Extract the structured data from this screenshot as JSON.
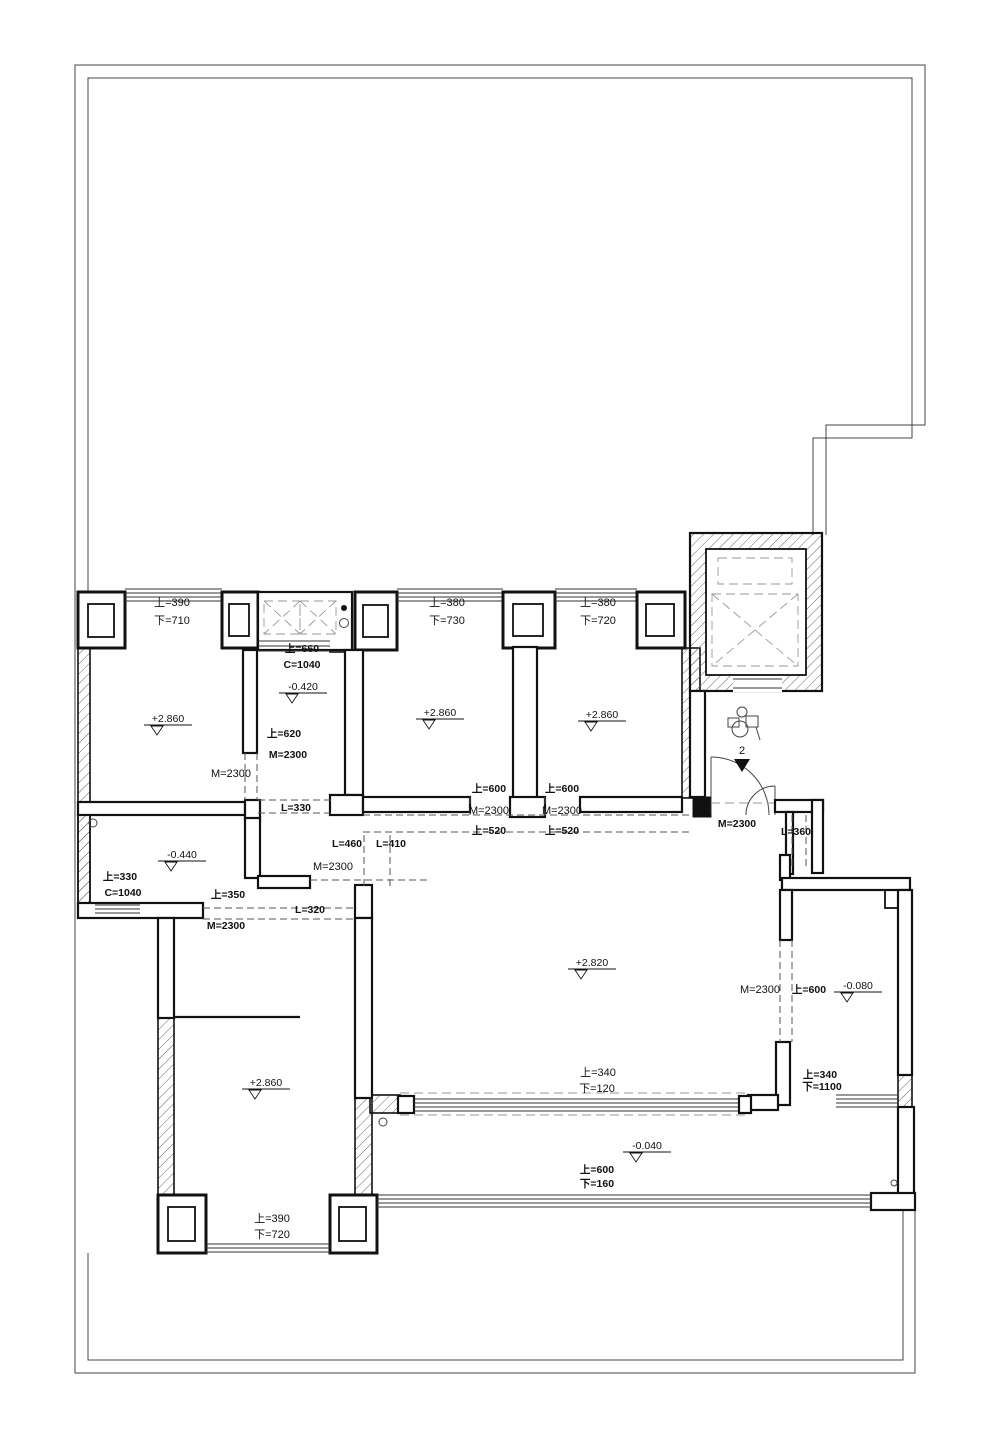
{
  "drawing": {
    "colors": {
      "wall": "#111111",
      "boundary": "#444444",
      "dashed_opening": "#555555",
      "background": "#ffffff"
    },
    "labels": [
      {
        "text": "上=390",
        "x": 172,
        "y": 606,
        "bold": false
      },
      {
        "text": "下=710",
        "x": 172,
        "y": 624,
        "bold": false
      },
      {
        "text": "上=380",
        "x": 447,
        "y": 606,
        "bold": false
      },
      {
        "text": "下=730",
        "x": 447,
        "y": 624,
        "bold": false
      },
      {
        "text": "上=380",
        "x": 598,
        "y": 606,
        "bold": false
      },
      {
        "text": "下=720",
        "x": 598,
        "y": 624,
        "bold": false
      },
      {
        "text": "上=660",
        "x": 302,
        "y": 652,
        "bold": true
      },
      {
        "text": "C=1040",
        "x": 302,
        "y": 668,
        "bold": true
      },
      {
        "text": "上=620",
        "x": 284,
        "y": 737,
        "bold": true
      },
      {
        "text": "M=2300",
        "x": 288,
        "y": 758,
        "bold": true
      },
      {
        "text": "M=2300",
        "x": 231,
        "y": 777,
        "bold": false
      },
      {
        "text": "L=330",
        "x": 296,
        "y": 811,
        "bold": true
      },
      {
        "text": "上=600",
        "x": 489,
        "y": 792,
        "bold": true
      },
      {
        "text": "M=2300",
        "x": 489,
        "y": 814,
        "bold": false
      },
      {
        "text": "上=520",
        "x": 489,
        "y": 834,
        "bold": true
      },
      {
        "text": "上=600",
        "x": 562,
        "y": 792,
        "bold": true
      },
      {
        "text": "M=2300",
        "x": 562,
        "y": 814,
        "bold": false
      },
      {
        "text": "上=520",
        "x": 562,
        "y": 834,
        "bold": true
      },
      {
        "text": "M=2300",
        "x": 737,
        "y": 827,
        "bold": true
      },
      {
        "text": "L=360",
        "x": 796,
        "y": 835,
        "bold": true
      },
      {
        "text": "上=330",
        "x": 120,
        "y": 880,
        "bold": true
      },
      {
        "text": "C=1040",
        "x": 123,
        "y": 896,
        "bold": true
      },
      {
        "text": "上=350",
        "x": 228,
        "y": 898,
        "bold": true
      },
      {
        "text": "L=460",
        "x": 347,
        "y": 847,
        "bold": true
      },
      {
        "text": "L=410",
        "x": 391,
        "y": 847,
        "bold": true
      },
      {
        "text": "M=2300",
        "x": 333,
        "y": 870,
        "bold": false
      },
      {
        "text": "L=320",
        "x": 310,
        "y": 913,
        "bold": true
      },
      {
        "text": "M=2300",
        "x": 226,
        "y": 929,
        "bold": true
      },
      {
        "text": "M=2300",
        "x": 760,
        "y": 993,
        "bold": false
      },
      {
        "text": "上=600",
        "x": 809,
        "y": 993,
        "bold": true
      },
      {
        "text": "上=340",
        "x": 598,
        "y": 1076,
        "bold": false
      },
      {
        "text": "下=120",
        "x": 597,
        "y": 1092,
        "bold": false
      },
      {
        "text": "上=340",
        "x": 820,
        "y": 1078,
        "bold": true
      },
      {
        "text": "下=1100",
        "x": 822,
        "y": 1090,
        "bold": true
      },
      {
        "text": "上=600",
        "x": 597,
        "y": 1173,
        "bold": true
      },
      {
        "text": "下=160",
        "x": 597,
        "y": 1187,
        "bold": true
      },
      {
        "text": "上=390",
        "x": 272,
        "y": 1222,
        "bold": false
      },
      {
        "text": "下=720",
        "x": 272,
        "y": 1238,
        "bold": false
      },
      {
        "text": "2",
        "x": 742,
        "y": 754,
        "bold": false
      }
    ],
    "levels": [
      {
        "value": "+2.860",
        "x": 168,
        "y": 722
      },
      {
        "value": "-0.420",
        "x": 303,
        "y": 690
      },
      {
        "value": "+2.860",
        "x": 440,
        "y": 716
      },
      {
        "value": "+2.860",
        "x": 602,
        "y": 718
      },
      {
        "value": "-0.440",
        "x": 182,
        "y": 858
      },
      {
        "value": "+2.820",
        "x": 592,
        "y": 966
      },
      {
        "value": "-0.080",
        "x": 858,
        "y": 989
      },
      {
        "value": "+2.860",
        "x": 266,
        "y": 1086
      },
      {
        "value": "-0.040",
        "x": 647,
        "y": 1149
      }
    ]
  }
}
